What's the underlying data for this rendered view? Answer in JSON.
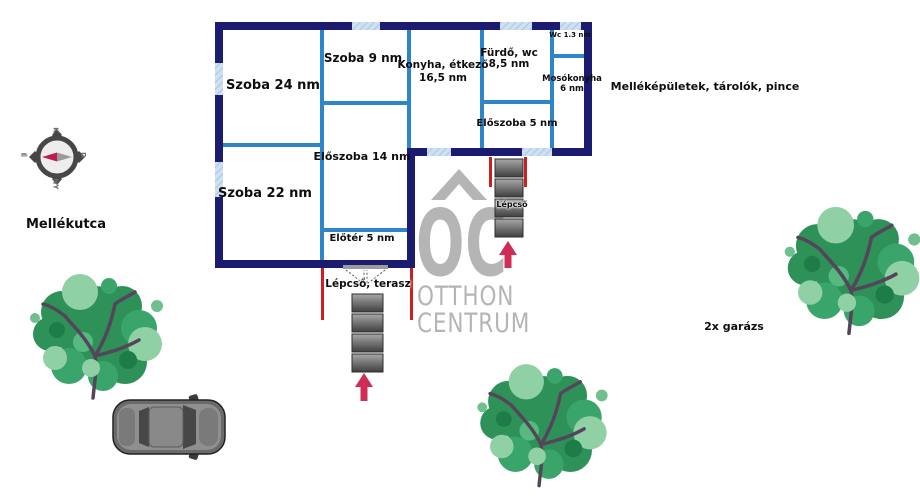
{
  "rooms": {
    "szoba24": {
      "label": "Szoba 24 nm"
    },
    "szoba9": {
      "label": "Szoba 9 nm"
    },
    "konyha": {
      "line1": "Konyha, étkező",
      "line2": "16,5 nm"
    },
    "furdo": {
      "line1": "Fürdő, wc",
      "line2": "8,5 nm"
    },
    "wc": {
      "label": "Wc 1.3 nm"
    },
    "mosokonyha": {
      "line1": "Mosókonyha",
      "line2": "6 nm"
    },
    "eloszoba5": {
      "label": "Előszoba 5 nm"
    },
    "eloszoba14": {
      "label": "Előszoba 14 nm"
    },
    "szoba22": {
      "label": "Szoba 22 nm"
    },
    "eloter": {
      "label": "Előtér 5 nm"
    }
  },
  "annotations": {
    "lepcso_terasz": "Lépcső, terasz",
    "lepcso": "Lépcső",
    "mellekutca": "Mellékutca",
    "mellekepuletek": "Melléképületek, tárolók, pince",
    "garazs": "2x garázs"
  },
  "logo": {
    "monogram": "OC",
    "line1": "OTTHON",
    "line2": "CENTRUM"
  },
  "compass": {
    "left": "É",
    "top": "K",
    "right": "D",
    "bottom": "NY"
  },
  "colors": {
    "outer_wall": "#1b1b70",
    "inner_wall": "#2e86c8",
    "window_fill": "#cfe1f0",
    "railing_red": "#cc2020",
    "arrow_pink": "#ce2d55",
    "stair_gray_top": "#a0a0a0",
    "stair_gray_bottom": "#3f3f3f",
    "logo_gray": "#b5b5b5",
    "tree_green": "#2e9158",
    "tree_light_green": "#8fd0a5",
    "compass_needle_red": "#c41a4f"
  }
}
